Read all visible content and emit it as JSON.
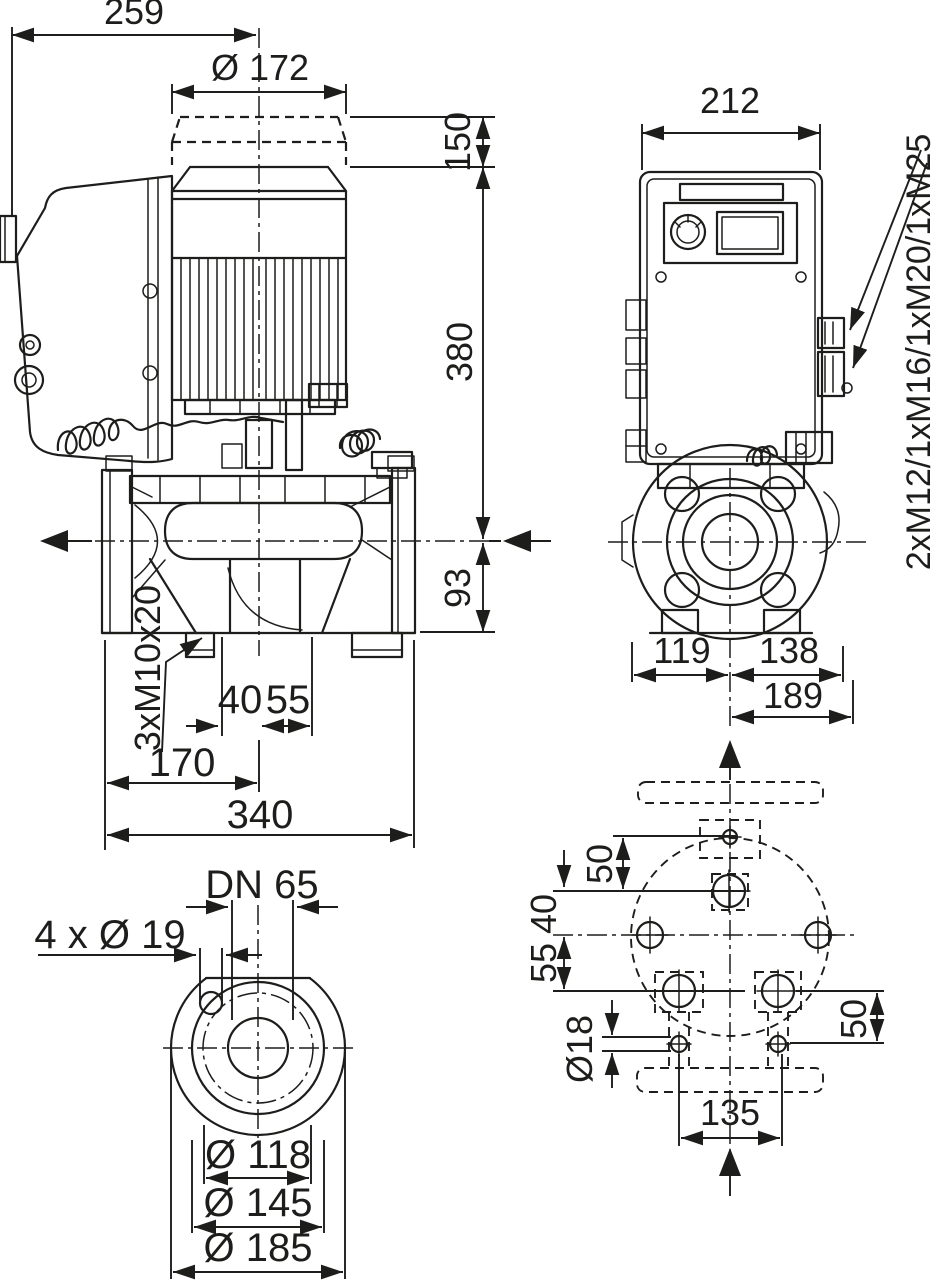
{
  "drawing": {
    "title": "pump-dimensional-drawing",
    "colors": {
      "ink": "#1d1d1b",
      "background": "#ffffff"
    },
    "side_view": {
      "overall_width": "259",
      "motor_diameter": "Ø 172",
      "removal_height": "150",
      "axis_to_top": "380",
      "axis_to_base": "93",
      "tapping_holes": "3xM10x20",
      "offset_40": "40",
      "offset_55": "55",
      "axis_to_flange": "170",
      "port_to_port": "340"
    },
    "front_view": {
      "module_width": "212",
      "cable_glands": "2xM12/1xM16/1xM20/1xM25",
      "axis_to_left": "119",
      "axis_to_right": "138",
      "axis_to_edge": "189"
    },
    "flange_view": {
      "nominal_bore": "DN 65",
      "bolt_holes": "4 x Ø 19",
      "bolt_circle": "Ø 118",
      "raised_face": "Ø 145",
      "outer_diameter": "Ø 185"
    },
    "plan_view": {
      "hole_pitch_top": "50",
      "offset_40": "40",
      "offset_55": "55",
      "hole_diameter": "Ø18",
      "hole_pitch_right": "50",
      "foot_pitch": "135"
    }
  }
}
